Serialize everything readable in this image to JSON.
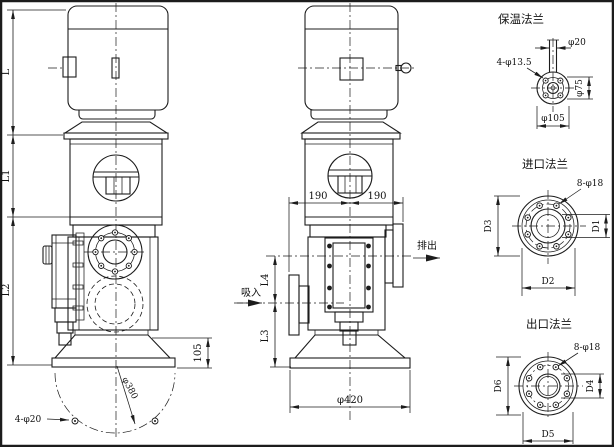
{
  "drawing": {
    "type": "pump_outline_installation_drawing",
    "colors": {
      "line": "#1c1c1c",
      "background": "#ffffff"
    },
    "side_view": {
      "dims": {
        "l": "L",
        "l1": "L1",
        "l2": "L2",
        "base_height": "105",
        "base_bolt_circle": "φ380",
        "base_holes": "4-φ20"
      }
    },
    "front_view": {
      "dims": {
        "span_left": "190",
        "span_right": "190",
        "l4": "L4",
        "l3": "L3",
        "base_dia": "φ420"
      },
      "labels": {
        "suction": "吸入",
        "discharge": "排出"
      }
    },
    "flanges": {
      "insulation": {
        "title": "保温法兰",
        "dims": {
          "pipe": "φ20",
          "holes": "4-φ13.5",
          "bolt_circle": "φ75",
          "od": "φ105"
        }
      },
      "inlet": {
        "title": "进口法兰",
        "dims": {
          "holes": "8-φ18",
          "d1": "D1",
          "d2": "D2",
          "d3": "D3"
        }
      },
      "outlet": {
        "title": "出口法兰",
        "dims": {
          "holes": "8-φ18",
          "d4": "D4",
          "d5": "D5",
          "d6": "D6"
        }
      }
    }
  }
}
